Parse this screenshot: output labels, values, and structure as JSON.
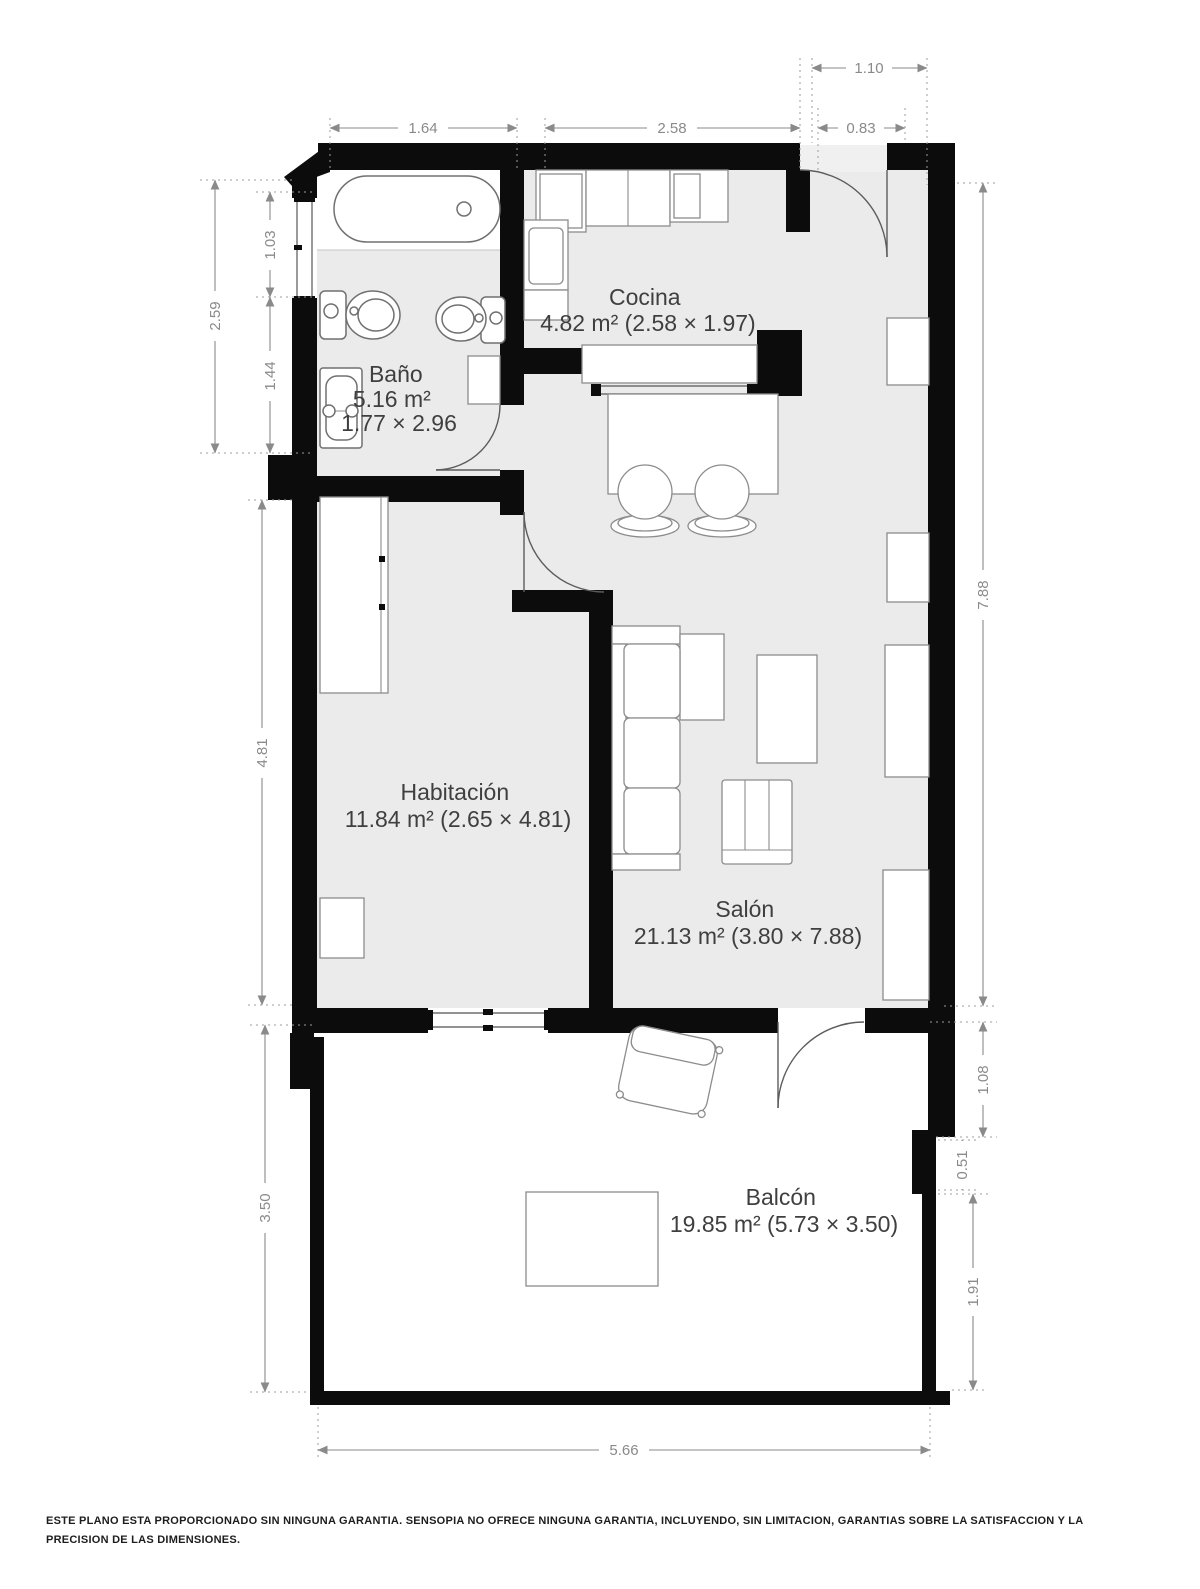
{
  "rooms": {
    "bano": {
      "name": "Baño",
      "area": "5.16 m²",
      "size": "1.77 × 2.96"
    },
    "cocina": {
      "name": "Cocina",
      "info": "4.82 m² (2.58 × 1.97)"
    },
    "habitacion": {
      "name": "Habitación",
      "info": "11.84 m² (2.65 × 4.81)"
    },
    "salon": {
      "name": "Salón",
      "info": "21.13 m² (3.80 × 7.88)"
    },
    "balcon": {
      "name": "Balcón",
      "info": "19.85 m² (5.73 × 3.50)"
    }
  },
  "dimensions": {
    "top_bathroom": "1.64",
    "top_kitchen": "2.58",
    "top_entry": "0.83",
    "top_entry_outer": "1.10",
    "left_bathroom_total": "2.59",
    "left_window": "1.03",
    "left_lower": "1.44",
    "left_bedroom": "4.81",
    "left_balcony": "3.50",
    "right_total": "7.88",
    "right_upper": "1.08",
    "right_step": "0.51",
    "right_lower": "1.91",
    "bottom_balcony": "5.66"
  },
  "colors": {
    "wall": "#0c0c0c",
    "floor": "#ebebeb",
    "dimension": "#8a8a8a",
    "label": "#3f3f3f"
  },
  "footer": "ESTE PLANO ESTA PROPORCIONADO SIN NINGUNA GARANTIA. SENSOPIA NO OFRECE NINGUNA GARANTIA, INCLUYENDO, SIN LIMITACION, GARANTIAS SOBRE LA SATISFACCION Y LA PRECISION DE LAS DIMENSIONES."
}
